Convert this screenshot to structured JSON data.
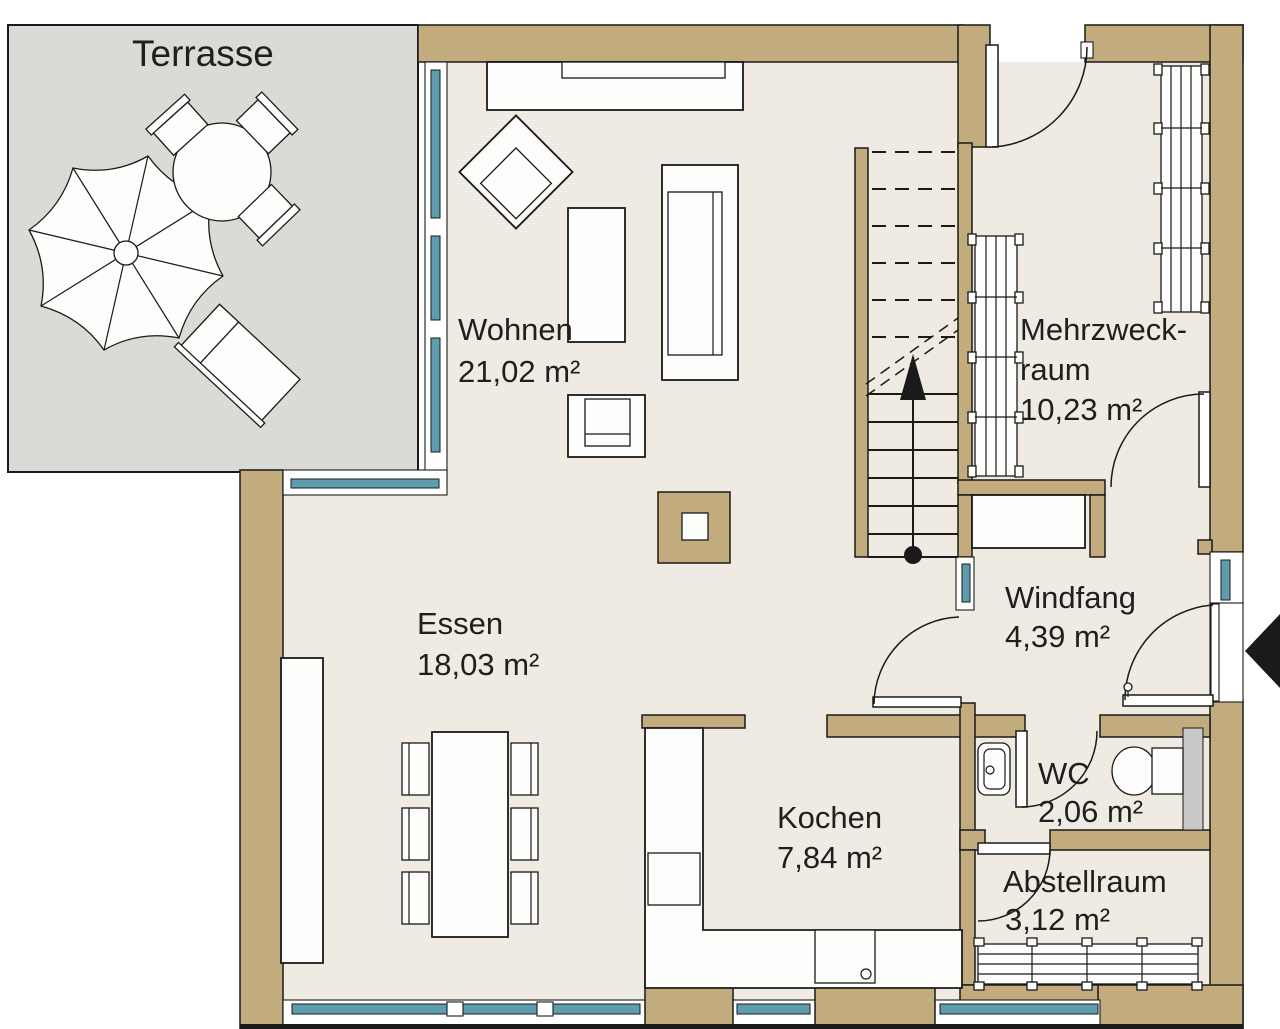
{
  "plan_type": "floor-plan",
  "rooms": {
    "terrasse": {
      "name": "Terrasse"
    },
    "wohnen": {
      "name": "Wohnen",
      "area": "21,02 m²"
    },
    "mehrzweckraum": {
      "name_line1": "Mehrzweck-",
      "name_line2": "raum",
      "area": "10,23 m²"
    },
    "essen": {
      "name": "Essen",
      "area": "18,03 m²"
    },
    "windfang": {
      "name": "Windfang",
      "area": "4,39 m²"
    },
    "wc": {
      "name": "WC",
      "area": "2,06 m²"
    },
    "kochen": {
      "name": "Kochen",
      "area": "7,84 m²"
    },
    "abstellraum": {
      "name": "Abstellraum",
      "area": "3,12 m²"
    }
  },
  "colors": {
    "wall": "#C2AB7D",
    "floor": "#EFEAE2",
    "terrace": "#DADAD6",
    "glass": "#5E9DAE",
    "line": "#1A1A1A",
    "fixture": "#FDFDFB",
    "duct": "#C9C9C9",
    "background": "#FFFFFF"
  }
}
